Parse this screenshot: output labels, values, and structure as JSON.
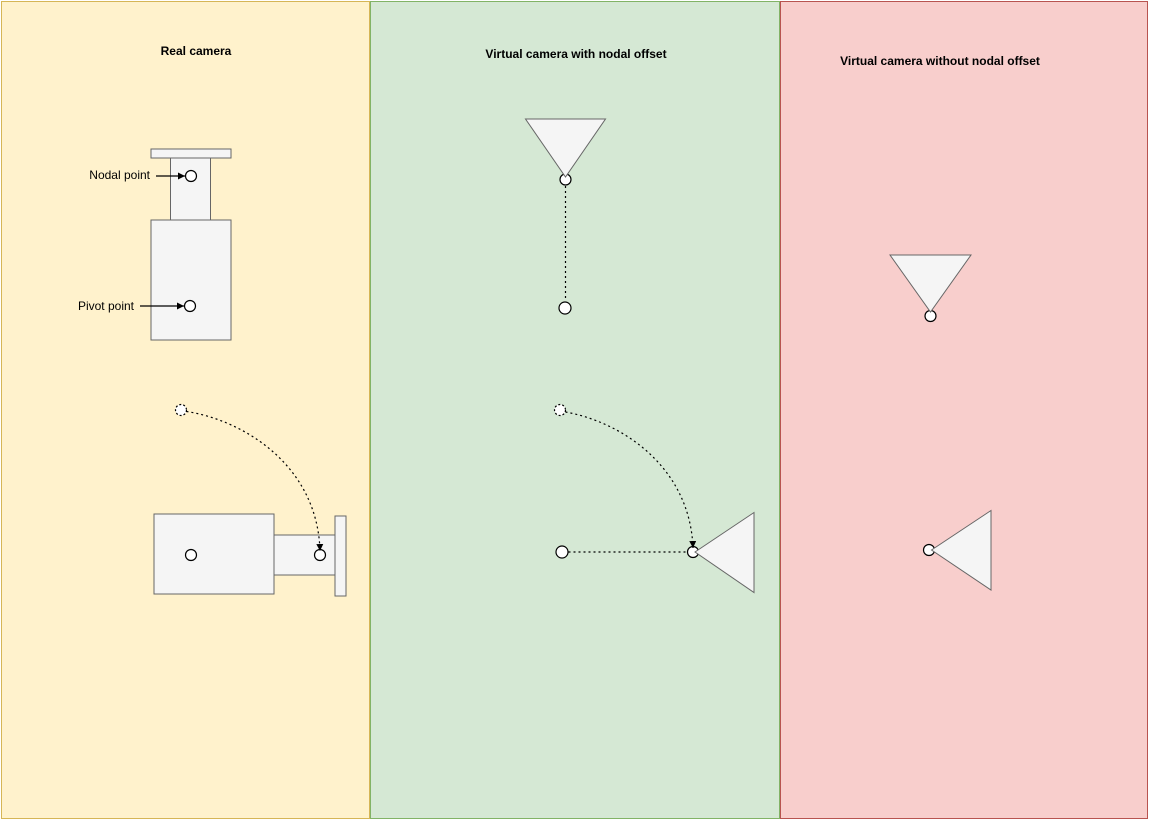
{
  "canvas": {
    "width": 1151,
    "height": 821,
    "background": "#FFFFFF"
  },
  "panels": [
    {
      "title": "Real camera",
      "fill": "#FFF2CC",
      "border": "#D6B656"
    },
    {
      "title": "Virtual camera with nodal offset",
      "fill": "#D5E8D4",
      "border": "#82B366"
    },
    {
      "title": "Virtual camera without nodal offset",
      "fill": "#F8CECC",
      "border": "#B85450"
    }
  ],
  "labels": {
    "nodal_point": "Nodal point",
    "pivot_point": "Pivot point"
  },
  "colors": {
    "camera_fill": "#F5F5F5",
    "camera_stroke": "#666666",
    "line": "#000000",
    "point_fill": "#FFFFFF"
  }
}
